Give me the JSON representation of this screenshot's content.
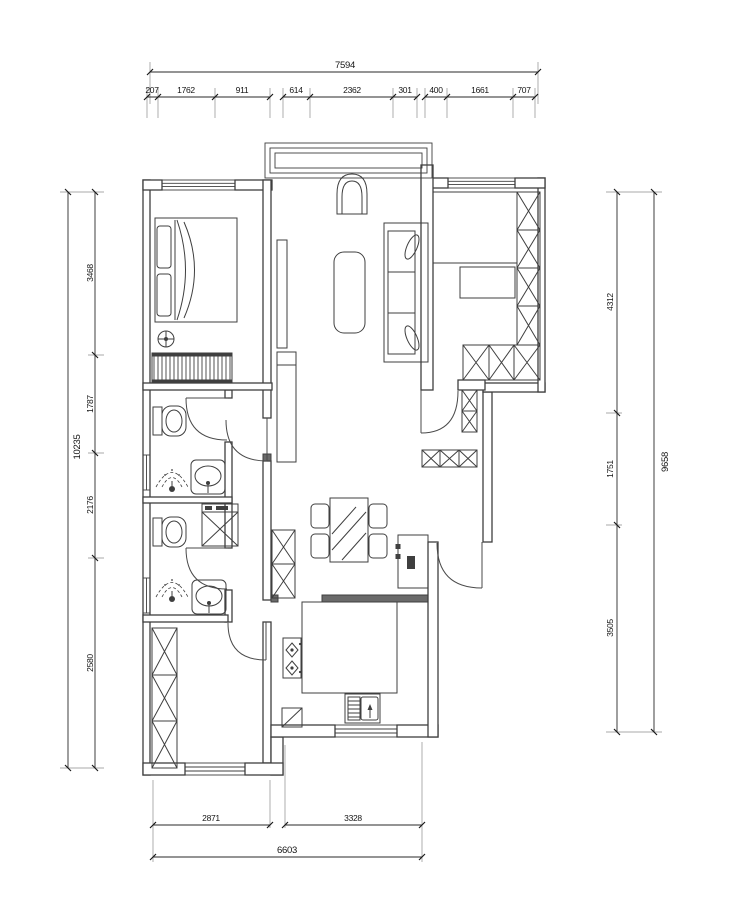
{
  "colors": {
    "line": "#3f3f3f",
    "dim_text": "#151515",
    "solid_wall": "#6a6a6a",
    "background": "#ffffff"
  },
  "dims": {
    "top": {
      "total": "7594",
      "segments": [
        "207",
        "1762",
        "911",
        "614",
        "2362",
        "301",
        "400",
        "1661",
        "707"
      ]
    },
    "left": {
      "total": "10235",
      "segments": [
        "3468",
        "1787",
        "2176",
        "2580"
      ]
    },
    "right": {
      "total": "9658",
      "segments": [
        "4312",
        "1751",
        "3505"
      ]
    },
    "bottom": {
      "total": "6603",
      "segments": [
        "2871",
        "3328"
      ]
    }
  }
}
